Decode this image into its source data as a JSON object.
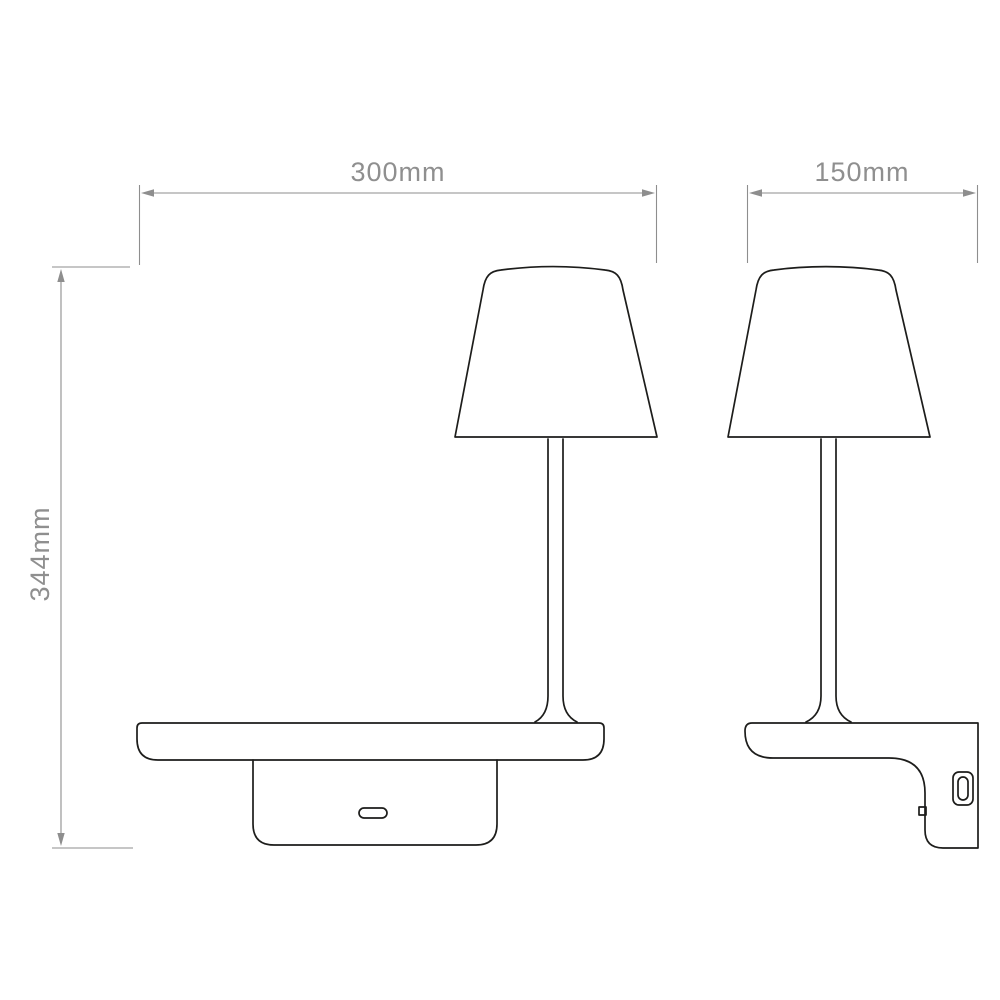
{
  "drawing": {
    "type": "technical-dimension-drawing",
    "subject": "wall-mounted shelf reading light, front and side elevation",
    "background_color": "#ffffff",
    "outline_color": "#1d1d1b",
    "dimension_color": "#8e8e8e",
    "labels": {
      "width": "300mm",
      "depth": "150mm",
      "height": "344mm"
    }
  }
}
